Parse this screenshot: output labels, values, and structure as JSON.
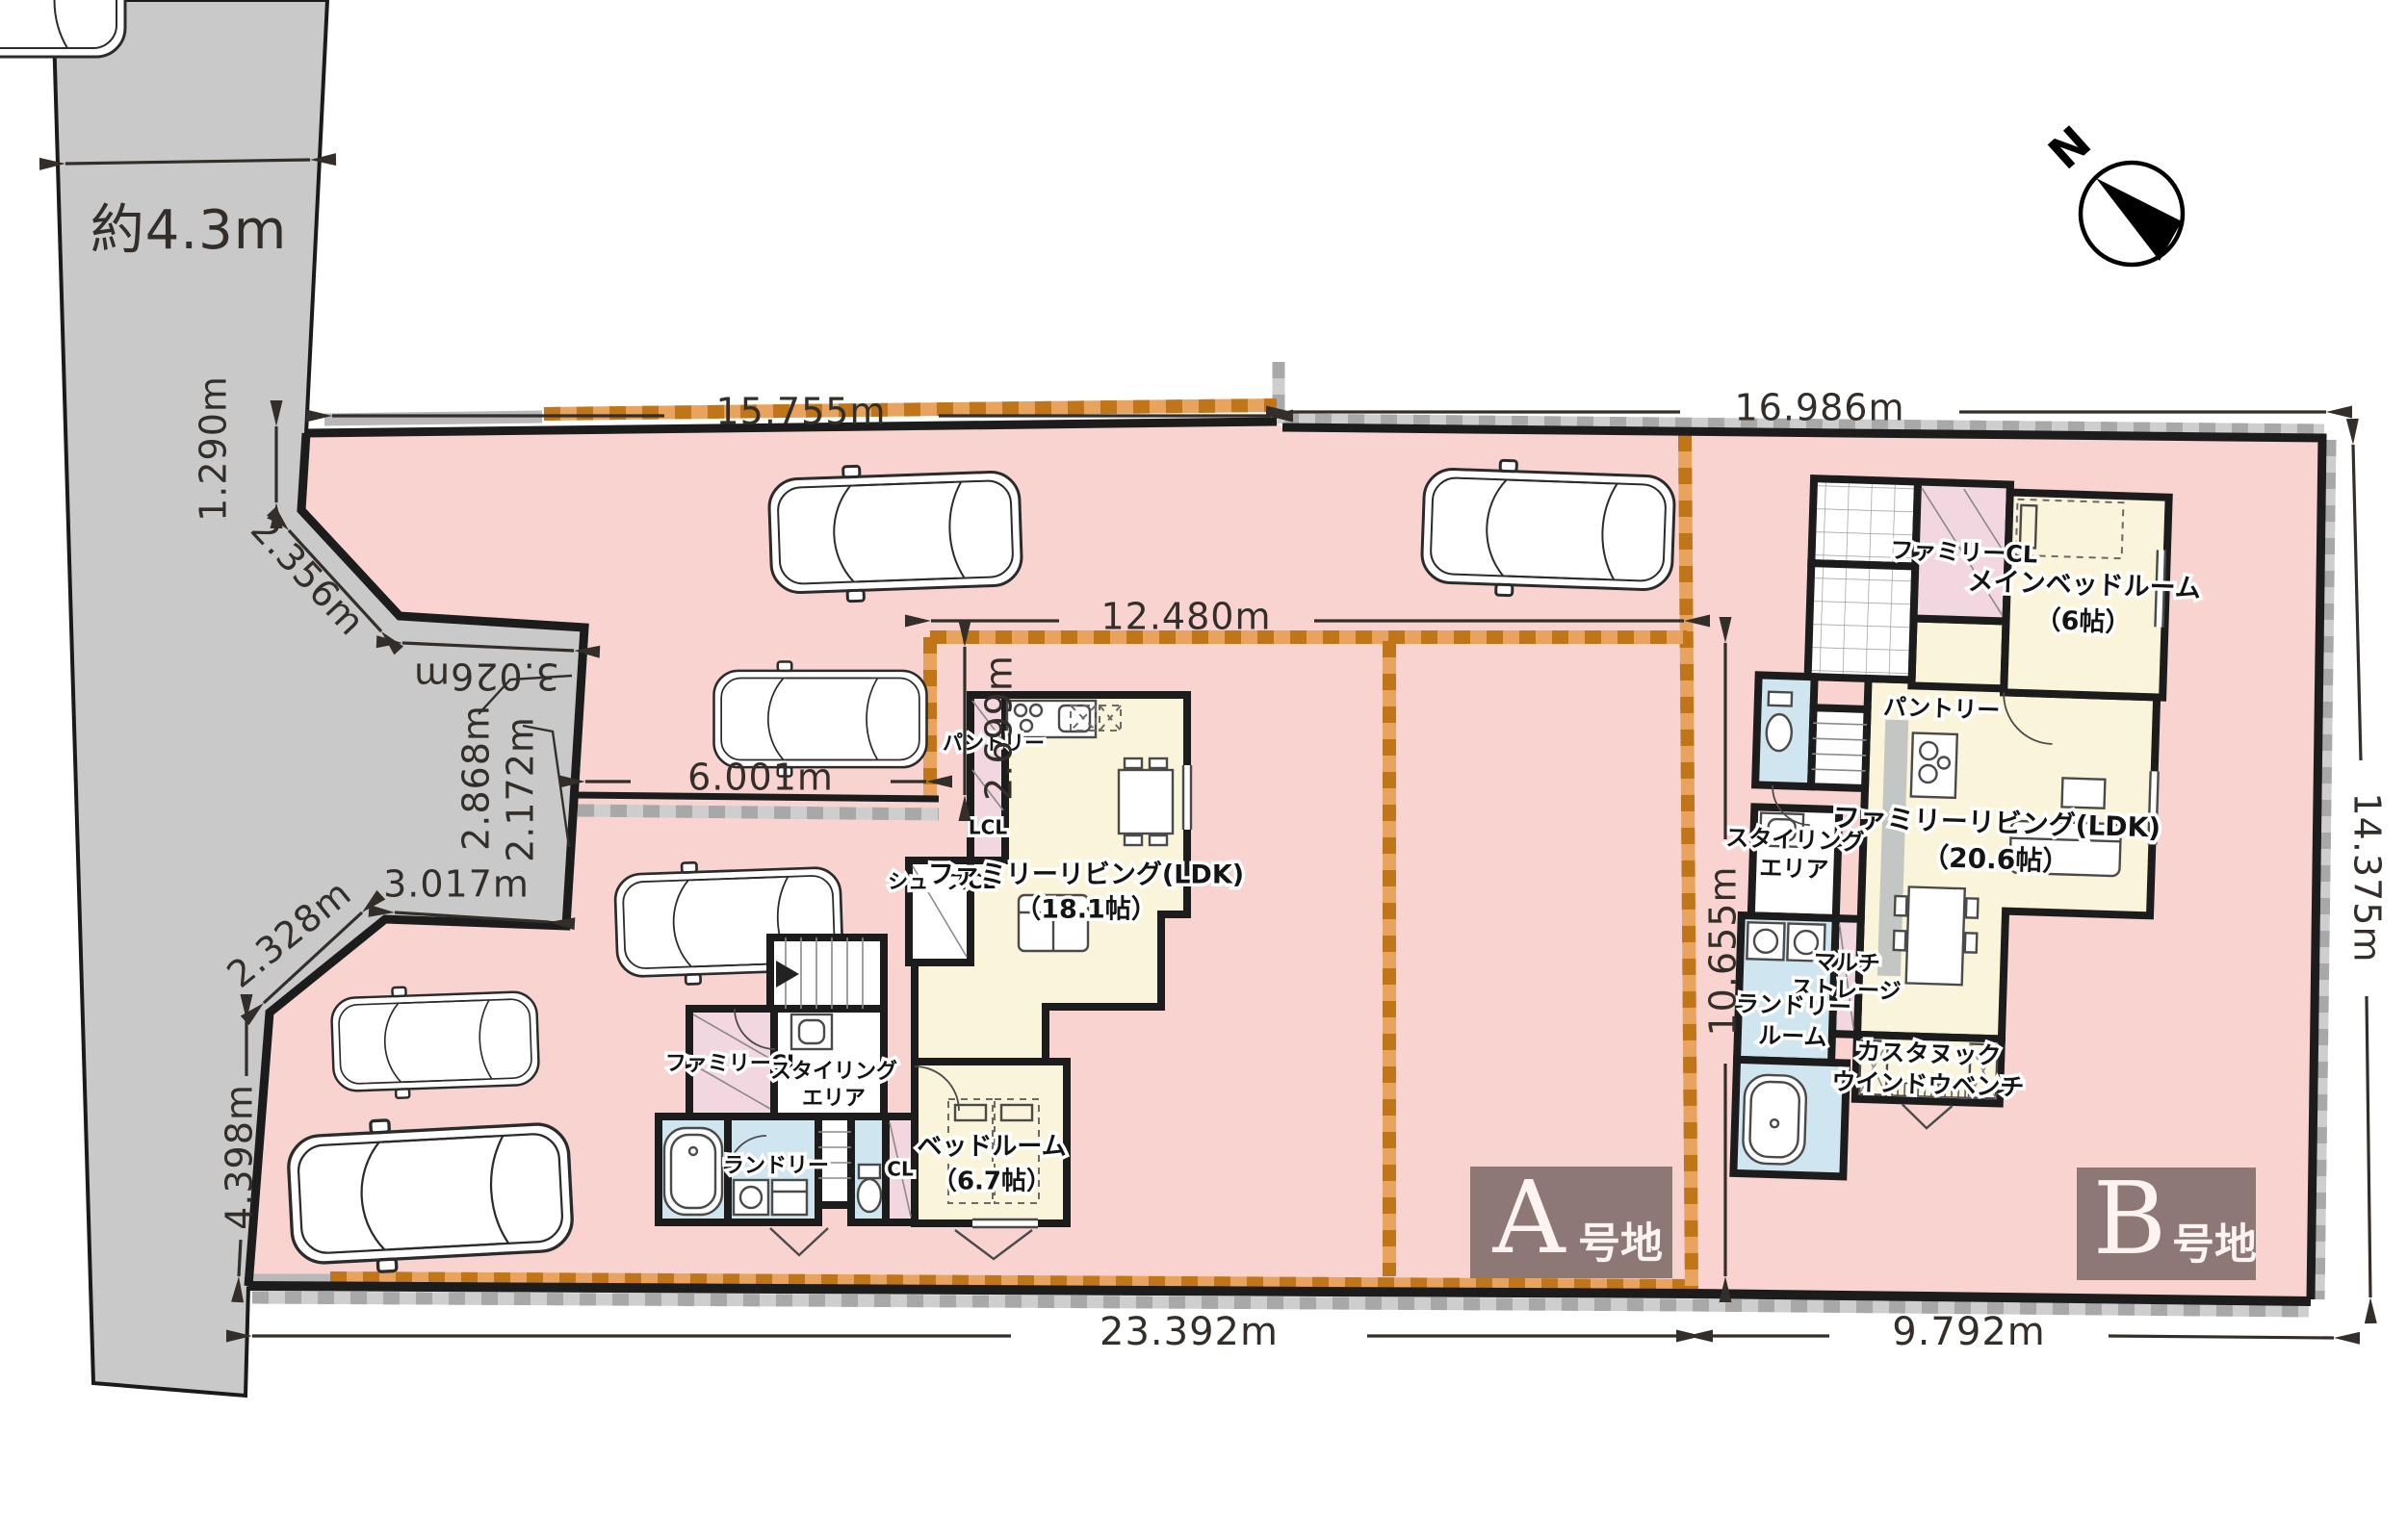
{
  "colors": {
    "lot_pink": "#f8d3d0",
    "road_gray": "#c9c9c9",
    "wall_black": "#1c1c1c",
    "room_yellow": "#faf5da",
    "room_pink": "#f3d7e0",
    "room_blue": "#cfe5ef",
    "checker_orange_dark": "#c07518",
    "checker_orange_light": "#e8a45e",
    "checker_gray_dark": "#a8a8a8",
    "checker_gray_light": "#cecece",
    "label_box_brown": "#8d7876",
    "dim_ink": "#332e29"
  },
  "compass": {
    "north_label": "N"
  },
  "road": {
    "width_label": "約4.3m"
  },
  "dims": {
    "top_a": "15.755m",
    "top_b": "16.986m",
    "inner_a_width": "12.480m",
    "driveway": "6.001m",
    "inner_a_offset": "2.699m",
    "inner_a_height": "10.655m",
    "b_right": "14.375m",
    "bottom_a": "23.392m",
    "bottom_b": "9.792m",
    "left_1": "1.290m",
    "left_2": "2.356m",
    "left_3": "3.026m",
    "left_4": "2.868m",
    "left_5": "2.172m",
    "left_6": "3.017m",
    "left_7": "2.328m",
    "left_8": "4.398m"
  },
  "lots": {
    "a": {
      "letter": "A",
      "suffix": "号地"
    },
    "b": {
      "letter": "B",
      "suffix": "号地"
    }
  },
  "house_a": {
    "pantry": "パントリー",
    "lcl": "LCL",
    "shoes_cl": "シューズCL",
    "ldk_1": "ファミリーリビング(LDK)",
    "ldk_2": "（18.1帖）",
    "family_cl": "ファミリーCL",
    "styling_1": "スタイリング",
    "styling_2": "エリア",
    "laundry": "ランドリー",
    "cl": "CL",
    "bedroom_1": "ベッドルーム",
    "bedroom_2": "（6.7帖）"
  },
  "house_b": {
    "family_cl": "ファミリーCL",
    "main_bedroom_1": "メインベッドルーム",
    "main_bedroom_2": "（6帖）",
    "pantry": "パントリー",
    "styling_1": "スタイリング",
    "styling_2": "エリア",
    "ldk_1": "ファミリーリビング(LDK)",
    "ldk_2": "（20.6帖）",
    "multi_1": "マルチ",
    "multi_2": "ストレージ",
    "laundry_1": "ランドリー",
    "laundry_2": "ルーム",
    "nook_1": "カスタヌック",
    "nook_2": "ウインドウベンチ"
  }
}
